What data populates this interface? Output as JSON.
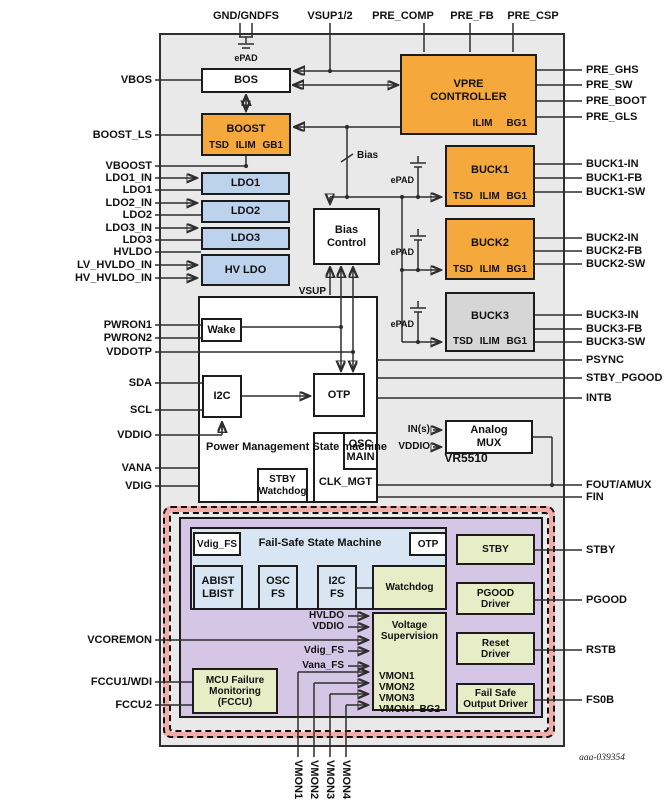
{
  "chip": {
    "name": "VR5510",
    "figure_id": "aaa-039354"
  },
  "pins": {
    "top": {
      "gnd": "GND/GNDFS",
      "vsup": "VSUP1/2",
      "pre_comp": "PRE_COMP",
      "pre_fb": "PRE_FB",
      "pre_csp": "PRE_CSP"
    },
    "left": {
      "vbos": "VBOS",
      "boost_ls": "BOOST_LS",
      "vboost": "VBOOST",
      "ldo1_in": "LDO1_IN",
      "ldo1": "LDO1",
      "ldo2_in": "LDO2_IN",
      "ldo2": "LDO2",
      "ldo3_in": "LDO3_IN",
      "ldo3": "LDO3",
      "hvldo": "HVLDO",
      "lv_hvldo_in": "LV_HVLDO_IN",
      "hv_hvldo_in": "HV_HVLDO_IN",
      "pwron1": "PWRON1",
      "pwron2": "PWRON2",
      "vddotp": "VDDOTP",
      "sda": "SDA",
      "scl": "SCL",
      "vddio": "VDDIO",
      "vana": "VANA",
      "vdig": "VDIG",
      "vcoremon": "VCOREMON",
      "fccu1": "FCCU1/WDI",
      "fccu2": "FCCU2"
    },
    "right": {
      "pre_ghs": "PRE_GHS",
      "pre_sw": "PRE_SW",
      "pre_boot": "PRE_BOOT",
      "pre_gls": "PRE_GLS",
      "buck1_in": "BUCK1-IN",
      "buck1_fb": "BUCK1-FB",
      "buck1_sw": "BUCK1-SW",
      "buck2_in": "BUCK2-IN",
      "buck2_fb": "BUCK2-FB",
      "buck2_sw": "BUCK2-SW",
      "buck3_in": "BUCK3-IN",
      "buck3_fb": "BUCK3-FB",
      "buck3_sw": "BUCK3-SW",
      "psync": "PSYNC",
      "stby_pgood": "STBY_PGOOD",
      "intb": "INTB",
      "fout_amux": "FOUT/AMUX",
      "fin": "FIN",
      "stby": "STBY",
      "pgood": "PGOOD",
      "rstb": "RSTB",
      "fs0b": "FS0B"
    },
    "bottom": {
      "vmon1": "VMON1",
      "vmon2": "VMON2",
      "vmon3": "VMON3",
      "vmon4": "VMON4"
    }
  },
  "blocks": {
    "bos": "BOS",
    "boost": {
      "title": "BOOST",
      "tsd": "TSD",
      "ilim": "ILIM",
      "gb1": "GB1"
    },
    "vpre": {
      "title": "VPRE CONTROLLER",
      "ilim": "ILIM",
      "bg1": "BG1"
    },
    "ldo1": "LDO1",
    "ldo2": "LDO2",
    "ldo3": "LDO3",
    "hvldo": "HV LDO",
    "bias_control": "Bias Control",
    "buck1": {
      "title": "BUCK1",
      "tsd": "TSD",
      "ilim": "ILIM",
      "bg1": "BG1"
    },
    "buck2": {
      "title": "BUCK2",
      "tsd": "TSD",
      "ilim": "ILIM",
      "bg1": "BG1"
    },
    "buck3": {
      "title": "BUCK3",
      "tsd": "TSD",
      "ilim": "ILIM",
      "bg1": "BG1"
    },
    "wake": "Wake",
    "pm_state_machine": "Power Management State machine",
    "i2c": "I2C",
    "otp": "OTP",
    "stby_watchdog": "STBY Watchdog",
    "osc_main": "OSC MAIN",
    "clk_mgt": "CLK_MGT",
    "analog_mux": "Analog MUX"
  },
  "failsafe": {
    "state_machine": "Fail-Safe State Machine",
    "vdig_fs": "Vdig_FS",
    "otp": "OTP",
    "abist_lbist": "ABIST LBIST",
    "osc_fs": "OSC FS",
    "i2c_fs": "I2C FS",
    "watchdog": "Watchdog",
    "voltage_supervision": {
      "title": "Voltage Supervision",
      "vmon1": "VMON1",
      "vmon2": "VMON2",
      "vmon3": "VMON3",
      "vmon4": "VMON4",
      "bg2": "BG2"
    },
    "mcu_monitoring": "MCU Failure Monitoring (FCCU)",
    "stby": "STBY",
    "pgood_driver": "PGOOD Driver",
    "reset_driver": "Reset Driver",
    "fs_output_driver": "Fail Safe Output Driver"
  },
  "labels": {
    "epad": "ePAD",
    "bias": "Bias",
    "vsup": "VSUP",
    "ins": "IN(s)",
    "vddio": "VDDIO",
    "hvldo": "HVLDO",
    "vddio_fs": "VDDIO",
    "vdig_fs": "Vdig_FS",
    "vana_fs": "Vana_FS"
  },
  "colors": {
    "orange": "#f5a83b",
    "ldo_blue": "#bdd2ec",
    "failsafe_blue": "#d8e6f4",
    "green": "#e7edc6",
    "purple": "#d6c6e6",
    "pink": "#f2acaa",
    "gray_block": "#d6d6d6",
    "chip_bg": "#e9e9e9"
  }
}
